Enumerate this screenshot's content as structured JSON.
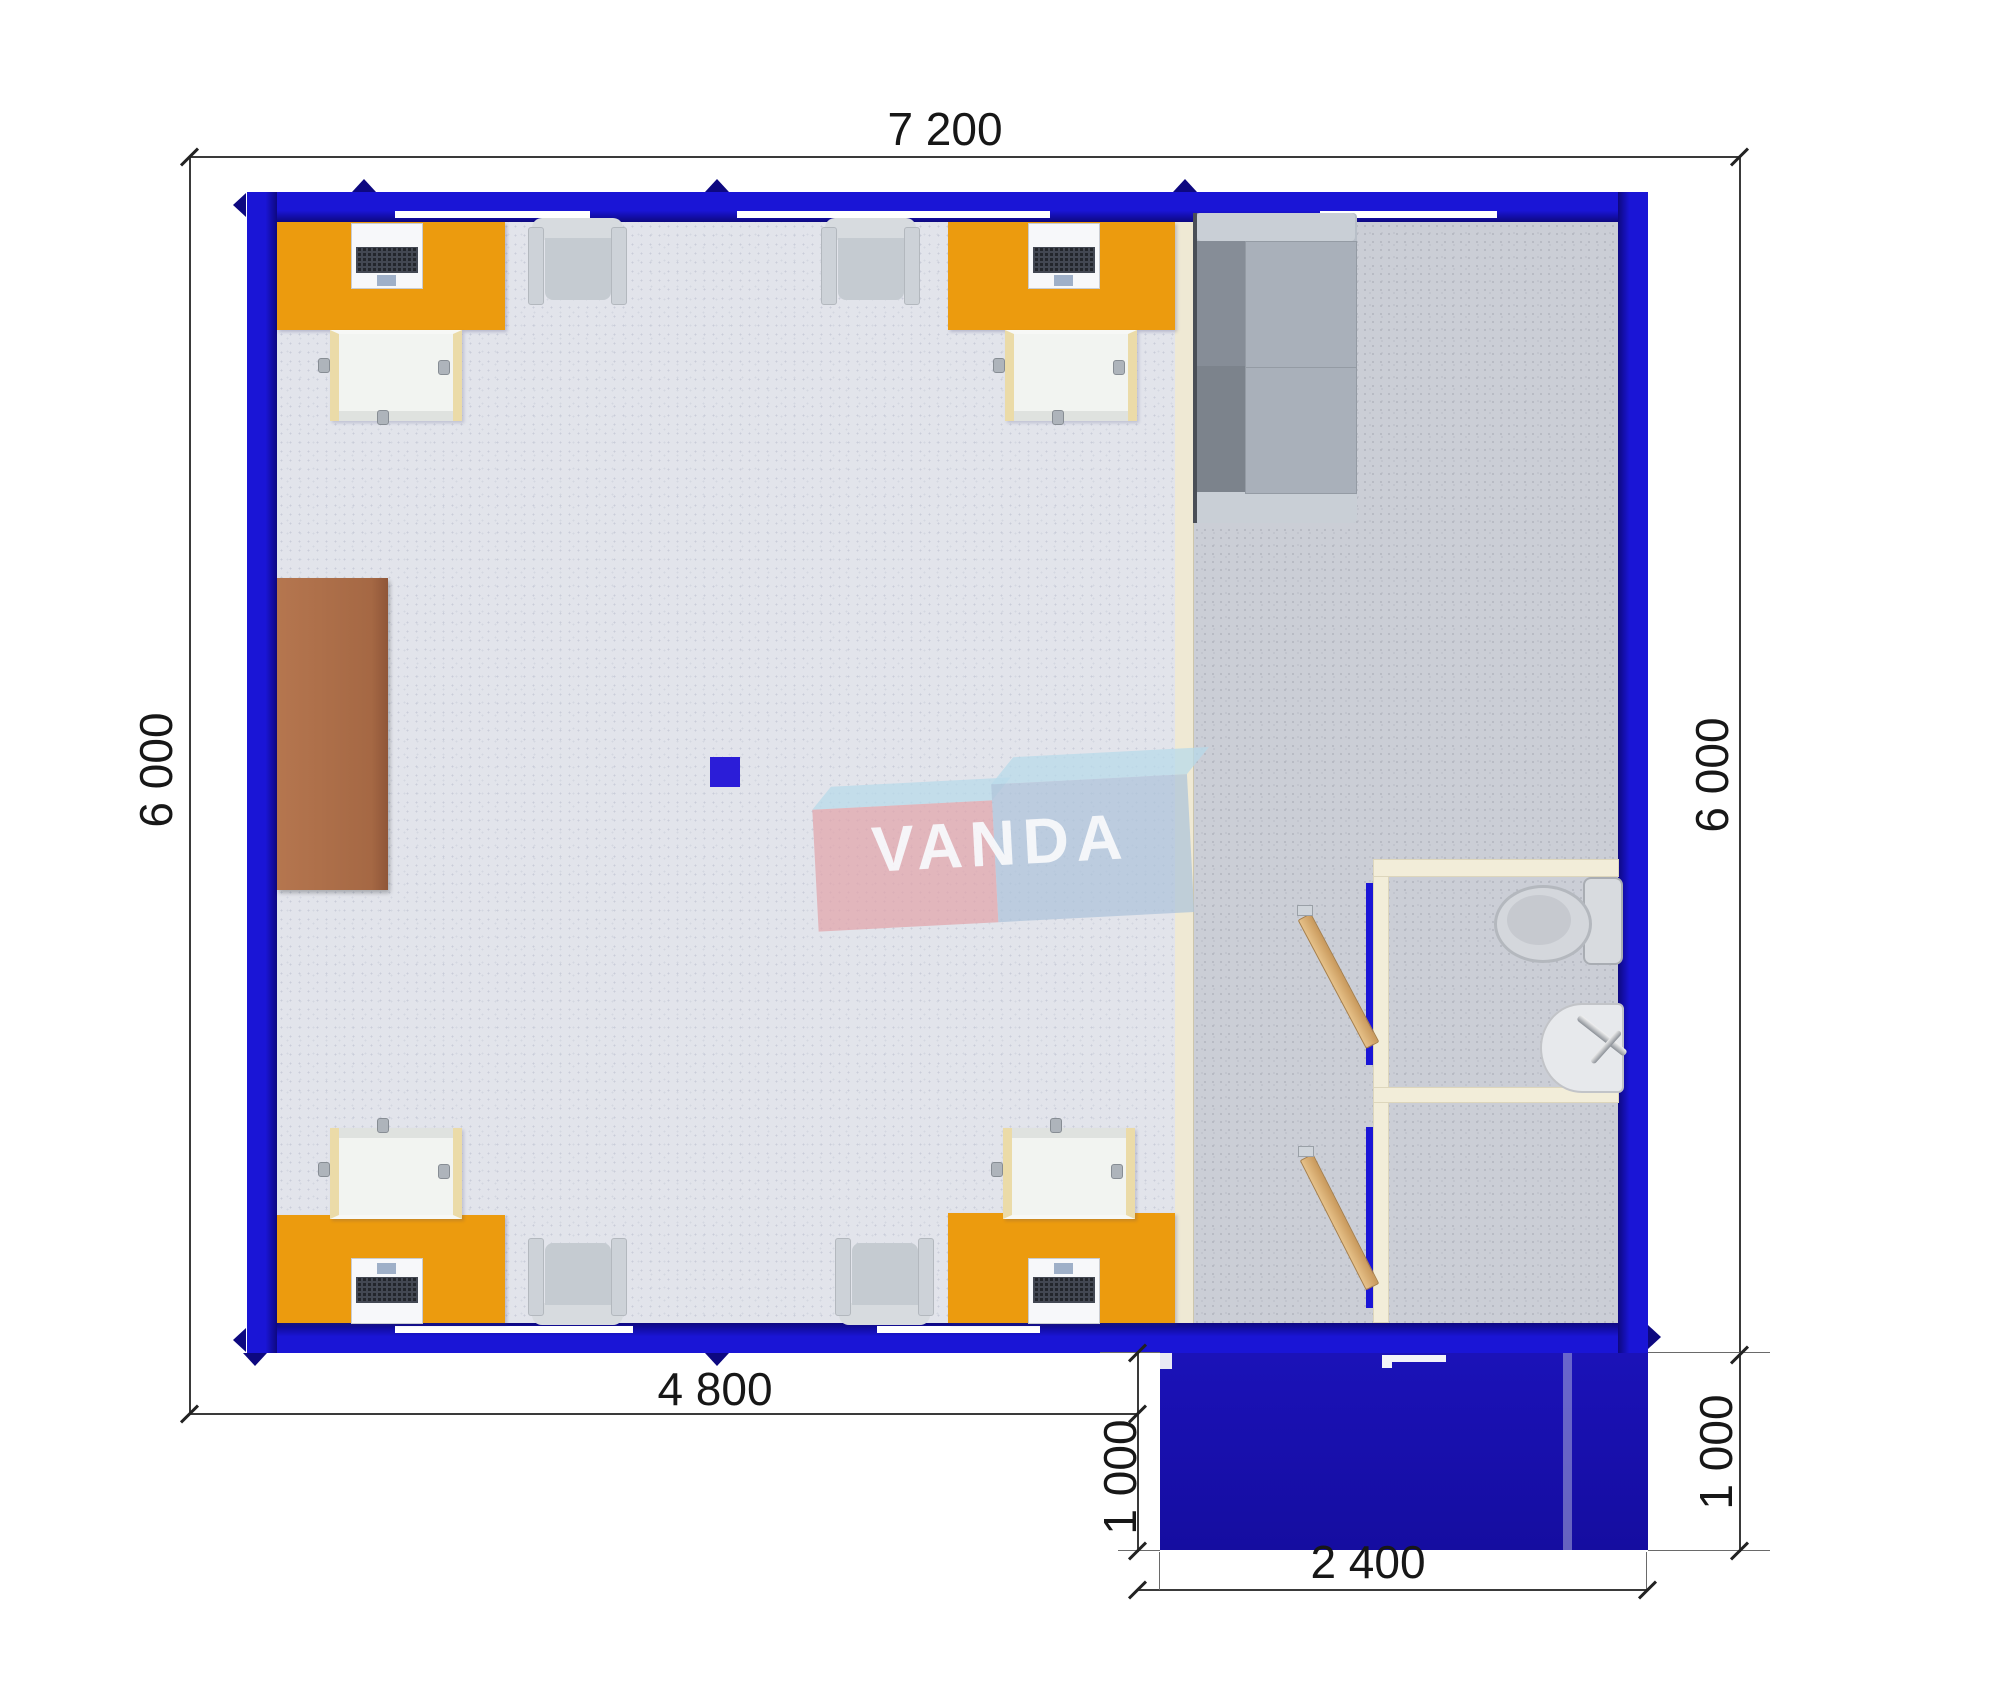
{
  "title": "VANDA modular office floor plan",
  "dimensions": {
    "top": "7 200",
    "left": "6 000",
    "right": "6 000",
    "bottom": "4 800",
    "porch_left": "1 000",
    "porch_right": "1 000",
    "porch_width": "2 400"
  },
  "logo": {
    "text": "VANDA"
  },
  "colors": {
    "wall_blue": "#1A15D6",
    "wall_blue_dark": "#0D0880",
    "porch_blue": "#1B12B8",
    "desk_orange": "#EC9B0E",
    "cabinet_brown": "#AF7050",
    "divider_cream": "#EFE9D4",
    "toilet_wall_cream": "#F2EDD9",
    "door_wood": "#D9AE6F",
    "floor_light": "#E2E4EB",
    "floor_dark": "#CBCED6",
    "logo_pink": "#E2A4AA",
    "logo_blue": "#ACC3DA",
    "logo_sky": "#B6DAEA",
    "column_blue": "#2B1DD8"
  }
}
